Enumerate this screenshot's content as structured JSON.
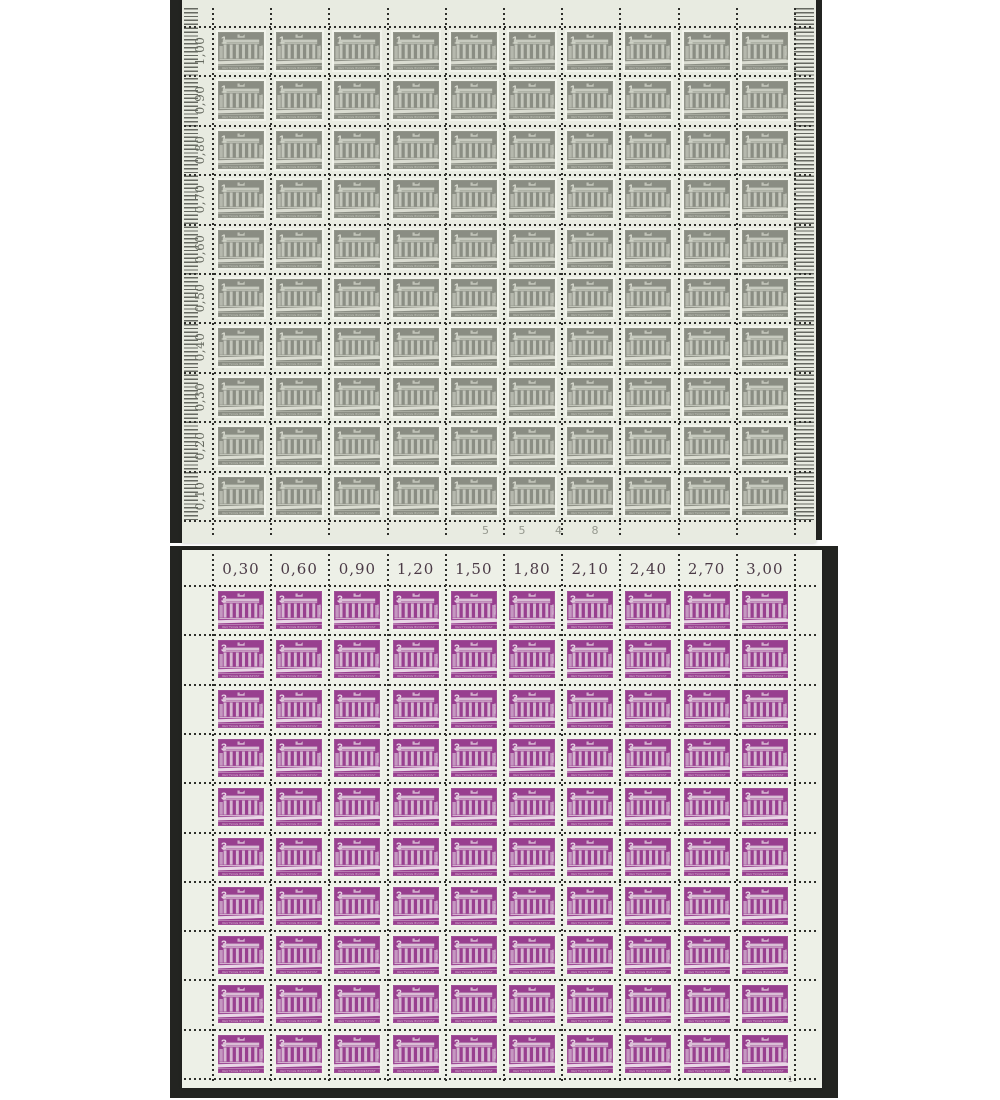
{
  "photo": {
    "background_color": "#ffffff",
    "dark_edge_color": "#232421"
  },
  "top_sheet": {
    "description": "full sheet of 100 grey 1 Pf Brandenburg Gate stamps",
    "denomination": "1",
    "rows": 10,
    "cols": 10,
    "paper_color": "#e8ebe1",
    "stamp_color": "#8a8d83",
    "design_color": "#c7cabf",
    "design_bright_color": "#dadcd1",
    "label_color": "#666a60",
    "row_labels": [
      "1,00",
      "0,90",
      "0,80",
      "0,70",
      "0,60",
      "0,50",
      "0,40",
      "0,30",
      "0,20",
      "0,10"
    ],
    "sheet_number": "5 5 4 8",
    "sheet_number_color": "#95988e",
    "inscription": "DEUTSCHE BUNDESPOST",
    "side_inscription": "BERLIN"
  },
  "bottom_sheet": {
    "description": "full sheet of 100 purple 3 Pf Brandenburg Gate stamps",
    "denomination": "3",
    "rows": 10,
    "cols": 10,
    "paper_color": "#edf0e7",
    "stamp_color": "#983f8f",
    "design_color": "#d9bed5",
    "design_bright_color": "#e9d6e6",
    "label_color": "#4b3a46",
    "col_labels": [
      "0,30",
      "0,60",
      "0,90",
      "1,20",
      "1,50",
      "1,80",
      "2,10",
      "2,40",
      "2,70",
      "3,00"
    ],
    "corner_mark": "1",
    "inscription": "DEUTSCHE BUNDESPOST",
    "side_inscription": "BERLIN"
  }
}
